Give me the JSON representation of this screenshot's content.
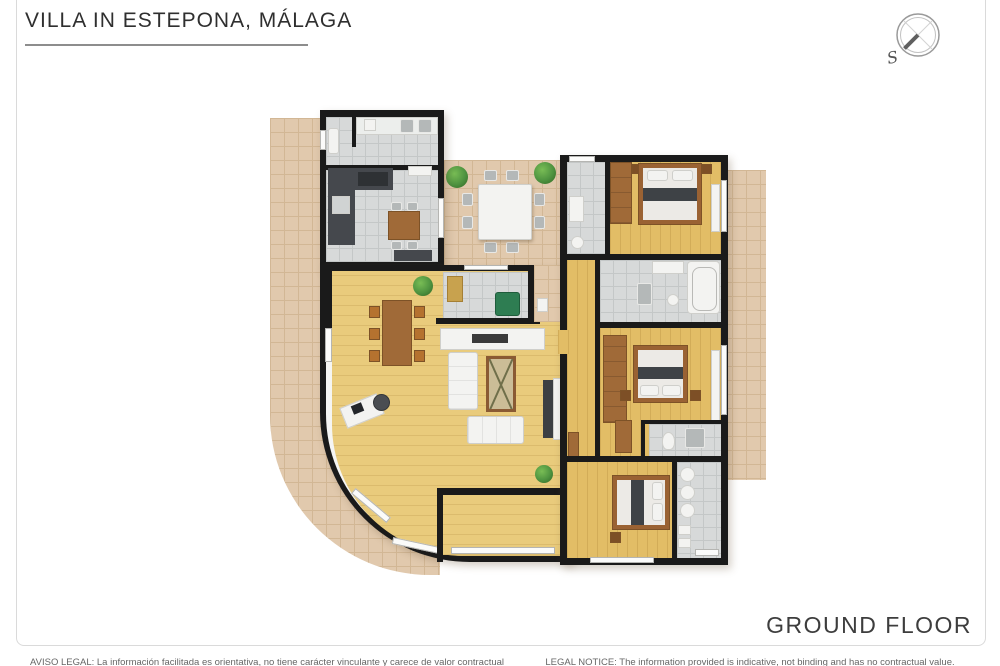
{
  "header": {
    "title": "VILLA IN ESTEPONA, MÁLAGA"
  },
  "compass": {
    "south_label": "S"
  },
  "footer": {
    "floor_label": "GROUND FLOOR",
    "legal_notice_es": "AVISO LEGAL: La información facilitada es orientativa, no tiene carácter vinculante y carece de valor contractual",
    "legal_notice_en": "LEGAL NOTICE: The information provided is indicative, not binding and has no contractual value."
  },
  "colors": {
    "wall": "#1a1a1a",
    "wood_floor": "#e2bd66",
    "tile_floor": "#d7d9d9",
    "terrace": "#e1c9ad",
    "wood_furniture": "#a06a38",
    "plant": "#4e9340",
    "accent_dark": "#45484d"
  }
}
